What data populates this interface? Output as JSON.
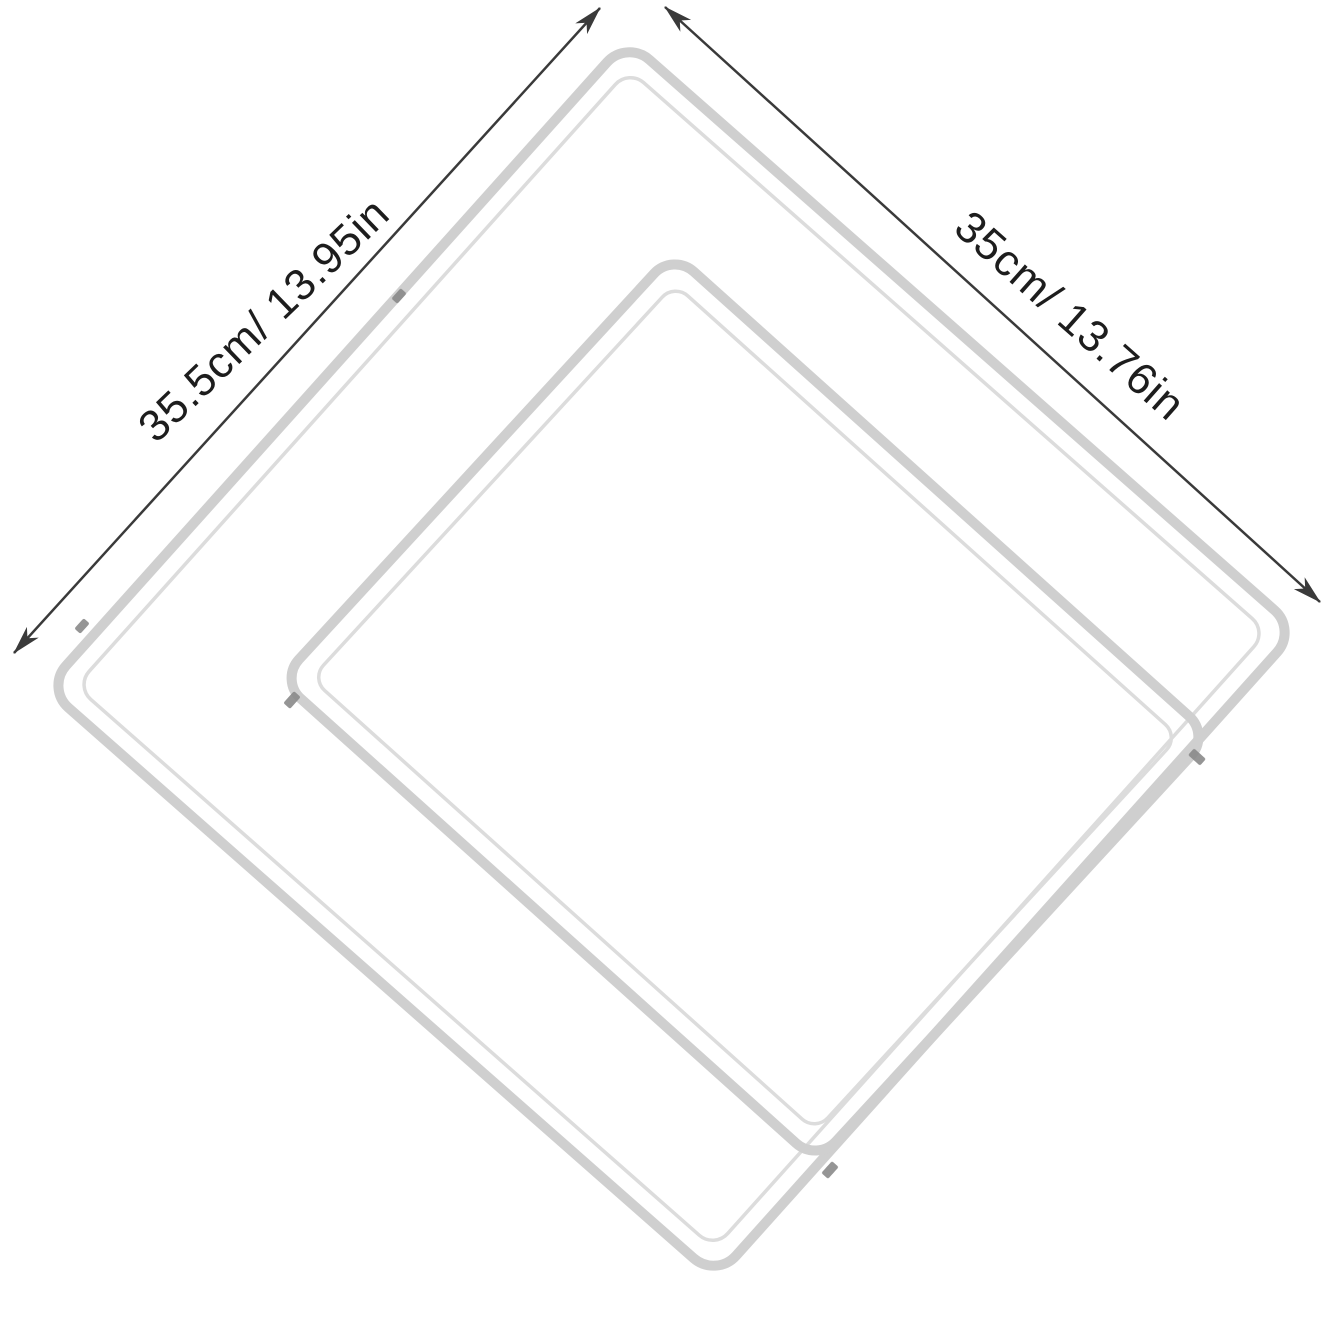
{
  "figure": {
    "type": "wire-shelf-dimension-diagram",
    "background": "#ffffff"
  },
  "dimension_labels": {
    "left": "35.5cm/ 13.95in",
    "right": "35cm/ 13.76in"
  },
  "style": {
    "arrow_color": "#3a3a3a",
    "label_color": "#1d1d1d",
    "frame_color": "#cfcfcf",
    "inner_loop_color": "#dcdcdc",
    "wire_color": "#d7d7d7",
    "clip_color": "#8a8a8a"
  }
}
